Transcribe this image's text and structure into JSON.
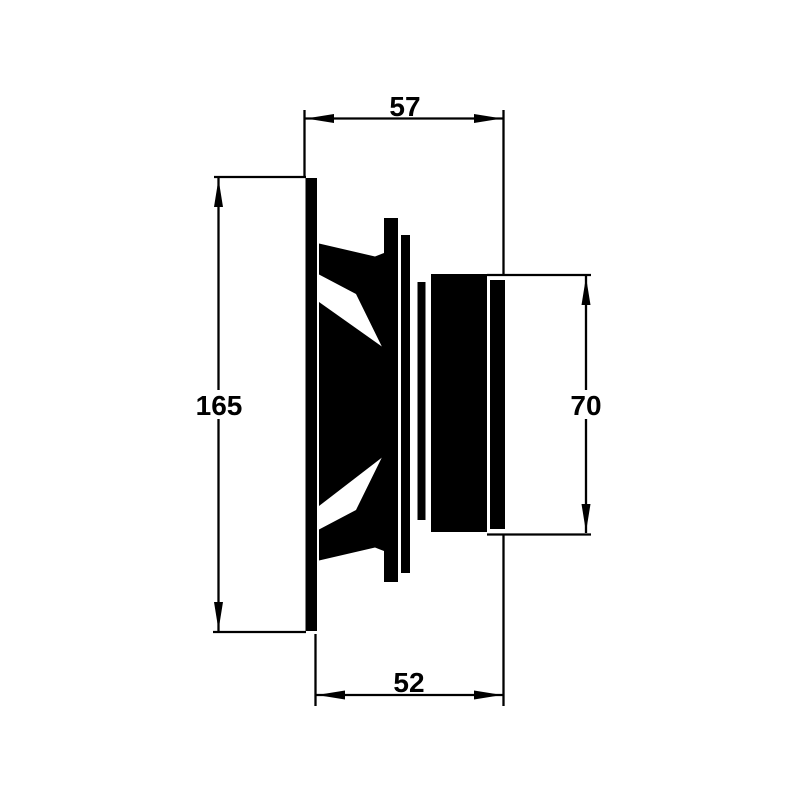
{
  "drawing": {
    "title": "Loudspeaker side-view dimensional drawing",
    "dimensions": {
      "top": "57",
      "left": "165",
      "right": "70",
      "bottom": "52"
    },
    "colors": {
      "ink": "#000000",
      "background": "#ffffff"
    }
  }
}
